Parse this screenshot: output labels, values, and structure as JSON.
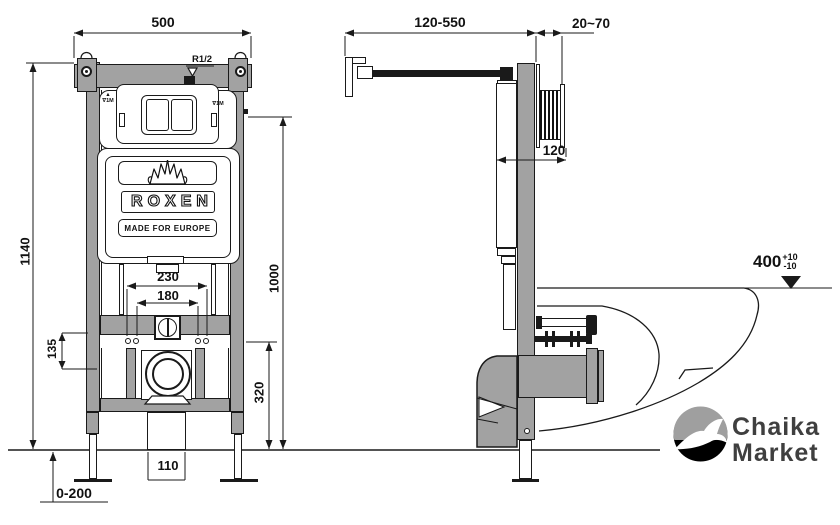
{
  "left_view": {
    "dim_frame_width": "500",
    "dim_frame_height": "1140",
    "dim_flush_plate_height": "1000",
    "dim_inlet_thread": "R1/2",
    "dim_stud_span_outer": "230",
    "dim_stud_span_inner": "180",
    "dim_crossbar_offset": "135",
    "dim_drain_center_height": "320",
    "dim_outlet_width": "110",
    "dim_leg_adjustment": "0-200",
    "marker_arrow": "▲",
    "marker_level_left": "∇1M",
    "marker_level_right": "∇1M"
  },
  "side_view": {
    "dim_bracket_range": "120-550",
    "dim_wall_thickness": "20~70",
    "dim_cistern_depth": "120",
    "dim_rim_height": "400",
    "dim_rim_tol_plus": "+10",
    "dim_rim_tol_minus": "-10"
  },
  "branding": {
    "logo_text": "ROXEN",
    "tagline": "MADE FOR EUROPE"
  },
  "watermark": {
    "line1": "Chaika",
    "line2": "Market"
  },
  "icons": {
    "crown": "crown-lotus-icon",
    "seagull": "seagull-icon"
  },
  "colors": {
    "line": "#1a1a1a",
    "metal": "#a2a2a2",
    "watermark_text": "#3f3f3f"
  }
}
